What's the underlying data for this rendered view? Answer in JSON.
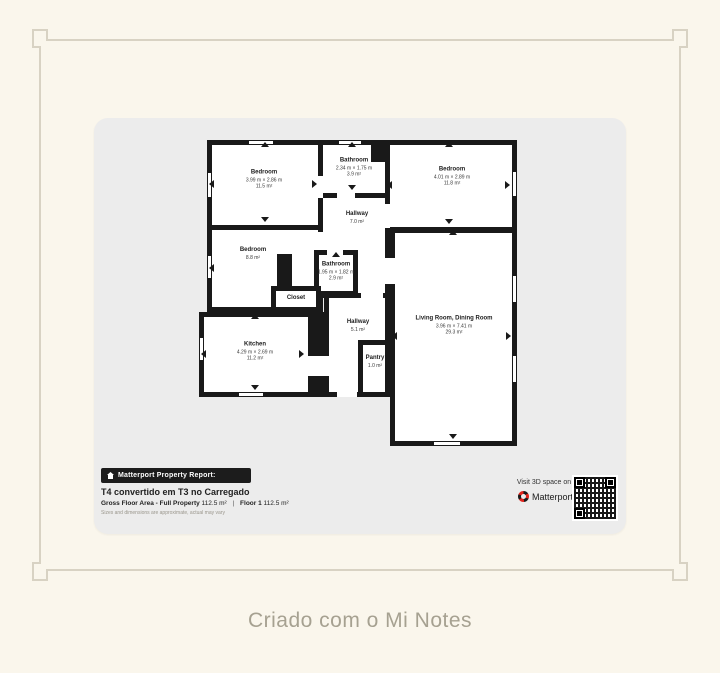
{
  "colors": {
    "page_bg": "#faf6ec",
    "frame": "#d8d2c3",
    "card_bg": "#ececec",
    "wall": "#191919",
    "brand_red": "#e0231c",
    "caption_text": "#a6a191"
  },
  "note": {
    "caption": "Criado com o Mi Notes"
  },
  "report": {
    "badge": "Matterport Property Report:",
    "title": "T4 convertido em T3 no Carregado",
    "area": {
      "gross_label": "Gross Floor Area - Full Property",
      "gross_value": "112.5 m²",
      "separator": "|",
      "floor_label": "Floor 1",
      "floor_value": "112.5 m²"
    },
    "disclaimer": "Sizes and dimensions are approximate, actual may vary",
    "visit": "Visit 3D space on",
    "brand": "Matterport"
  },
  "rooms": {
    "bedroom_tl": {
      "name": "Bedroom",
      "dims": "3.99 m × 2.86 m",
      "area": "11.5 m²"
    },
    "bathroom_top": {
      "name": "Bathroom",
      "dims": "2.34 m × 1.75 m",
      "area": "3.9 m²"
    },
    "bedroom_tr": {
      "name": "Bedroom",
      "dims": "4.01 m × 2.89 m",
      "area": "11.8 m²"
    },
    "hallway_upper": {
      "name": "Hallway",
      "area": "7.0 m²"
    },
    "bedroom_ml": {
      "name": "Bedroom",
      "area": "8.8 m²"
    },
    "bathroom_mid": {
      "name": "Bathroom",
      "dims": "1.95 m × 1.82 m",
      "area": "2.9 m²"
    },
    "closet": {
      "name": "Closet"
    },
    "kitchen": {
      "name": "Kitchen",
      "dims": "4.29 m × 2.69 m",
      "area": "11.2 m²"
    },
    "hallway_lower": {
      "name": "Hallway",
      "area": "5.1 m²"
    },
    "pantry": {
      "name": "Pantry",
      "area": "1.0 m²"
    },
    "living": {
      "name": "Living Room, Dining Room",
      "dims": "3.96 m × 7.41 m",
      "area": "29.3 m²"
    }
  }
}
